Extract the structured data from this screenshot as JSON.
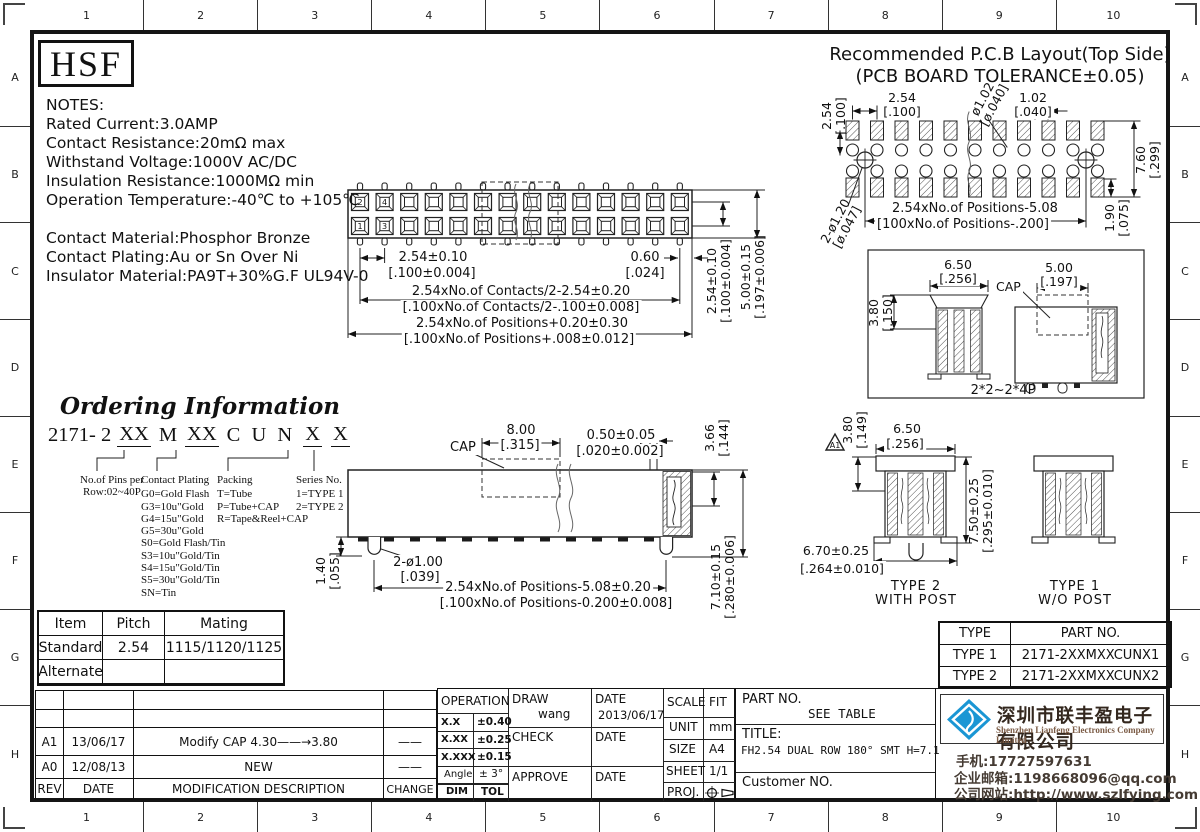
{
  "colors": {
    "accent_blue": "#1a96d4",
    "company_name": "#33271e",
    "company_sub": "#7b5b45",
    "line": "#1a1a1a"
  },
  "sheet": {
    "zones_cols": [
      "1",
      "2",
      "3",
      "4",
      "5",
      "6",
      "7",
      "8",
      "9",
      "10"
    ],
    "zones_rows": [
      "A",
      "B",
      "C",
      "D",
      "E",
      "F",
      "G",
      "H"
    ]
  },
  "logo_text": "HSF",
  "notes": {
    "lines": [
      "NOTES:",
      "Rated Current:3.0AMP",
      "Contact Resistance:20mΩ max",
      "Withstand Voltage:1000V AC/DC",
      "Insulation Resistance:1000MΩ min",
      "Operation Temperature:-40℃ to +105℃",
      "",
      "Contact Material:Phosphor Bronze",
      "Contact Plating:Au or Sn Over Ni",
      "Insulator Material:PA9T+30%G.F UL94V-0"
    ]
  },
  "pcb": {
    "title1": "Recommended P.C.B Layout(Top Side)",
    "title2": "(PCB BOARD TOLERANCE±0.05)",
    "dim_row_pitch_v": [
      "2.54",
      "[.100]"
    ],
    "dim_pitch": [
      "2.54",
      "[.100]"
    ],
    "dim_hole_sm": [
      "ø1.02",
      "[ø.040]"
    ],
    "dim_half": [
      "1.02",
      "[.040]"
    ],
    "dim_span_v": [
      "7.60",
      "[.299]"
    ],
    "dim_off_v": [
      "1.90",
      "[.075]"
    ],
    "dim_hole_lg": [
      "2-ø1.20",
      "[ø.047]"
    ],
    "dim_positions": [
      "2.54xNo.of Positions-5.08",
      "[100xNo.of Positions-.200]"
    ]
  },
  "top_view": {
    "pins": [
      "2",
      "4",
      "1",
      "3"
    ],
    "dim_pitch": [
      "2.54±0.10",
      "[.100±0.004]"
    ],
    "dim_end": [
      "0.60",
      "[.024]"
    ],
    "dim_contacts": [
      "2.54xNo.of Contacts/2-2.54±0.20",
      "[.100xNo.of Contacts/2-.100±0.008]"
    ],
    "dim_positions": [
      "2.54xNo.of Positions+0.20±0.30",
      "[.100xNo.of Positions+.008±0.012]"
    ],
    "dim_row_v": [
      "2.54±0.10",
      "[.100±0.004]"
    ],
    "dim_body_v": [
      "5.00±0.15",
      "[.197±0.006]"
    ]
  },
  "section_box": {
    "dim_left_w": [
      "6.50",
      "[.256]"
    ],
    "dim_cap_w": [
      "5.00",
      "[.197]"
    ],
    "cap_label": "CAP",
    "dim_cap_h_v": [
      "3.80",
      "[.150]"
    ],
    "range_label": "2*2~2*4P"
  },
  "ordering": {
    "title": "Ordering Information",
    "code": [
      "2171- 2",
      "XX",
      "M",
      "XX",
      "C U N",
      "X",
      "X"
    ],
    "pins_l1": "No.of Pins per",
    "pins_l2": "Row:02~40P",
    "plating_title": "Contact Plating",
    "plating": [
      "G0=Gold Flash",
      "G3=10u\"Gold",
      "G4=15u\"Gold",
      "G5=30u\"Gold",
      "S0=Gold Flash/Tin",
      "S3=10u\"Gold/Tin",
      "S4=15u\"Gold/Tin",
      "S5=30u\"Gold/Tin",
      "SN=Tin"
    ],
    "packing_title": "Packing",
    "packing": [
      "T=Tube",
      "P=Tube+CAP",
      "R=Tape&Reel+CAP"
    ],
    "series_title": "Series No.",
    "series": [
      "1=TYPE 1",
      "2=TYPE 2"
    ]
  },
  "side_view": {
    "cap_label": "CAP",
    "dim_cap": [
      "8.00",
      "[.315]"
    ],
    "dim_pad": [
      "0.50±0.05",
      "[.020±0.002]"
    ],
    "dim_ch_v": [
      "3.66",
      "[.144]"
    ],
    "dim_post": [
      "2-ø1.00",
      "[.039]"
    ],
    "dim_ph_v": [
      "1.40",
      "[.055]"
    ],
    "dim_positions": [
      "2.54xNo.of Positions-5.08±0.20",
      "[.100xNo.of Positions-0.200±0.008]"
    ],
    "dim_h_v": [
      "7.10±0.15",
      "[.280±0.006]"
    ]
  },
  "type_views": {
    "flag": "A1",
    "dim_cap_v": [
      "3.80",
      "[.149]"
    ],
    "dim_w": [
      "6.50",
      "[.256]"
    ],
    "dim_h_v": [
      "7.50±0.25",
      "[.295±0.010]"
    ],
    "dim_feet": [
      "6.70±0.25",
      "[.264±0.010]"
    ],
    "type2_l1": "TYPE 2",
    "type2_l2": "WITH POST",
    "type1_l1": "TYPE 1",
    "type1_l2": "W/O POST"
  },
  "mating_table": {
    "headers": [
      "Item",
      "Pitch",
      "Mating"
    ],
    "rows": [
      [
        "Standard",
        "2.54",
        "1115/1120/1125"
      ],
      [
        "Alternate",
        "",
        ""
      ]
    ]
  },
  "revision_table": {
    "headers": [
      "REV",
      "DATE",
      "MODIFICATION DESCRIPTION",
      "CHANGE"
    ],
    "rows": [
      {
        "rev": "A1",
        "date": "13/06/17",
        "desc": "Modify CAP 4.30——→3.80",
        "change": "——"
      },
      {
        "rev": "A0",
        "date": "12/08/13",
        "desc": "NEW",
        "change": "——"
      }
    ]
  },
  "title_block": {
    "operation_label": "OPERATION",
    "tol": [
      {
        "k": "X.X",
        "v": "±0.40"
      },
      {
        "k": "X.XX",
        "v": "±0.25"
      },
      {
        "k": "X.XXX",
        "v": "±0.15"
      },
      {
        "k": "Angle",
        "v": "± 3°"
      },
      {
        "k": "DIM",
        "v": "TOL"
      }
    ],
    "draw_label": "DRAW",
    "drawn_by": "wang",
    "date_label": "DATE",
    "draw_date": "2013/06/17",
    "check_label": "CHECK",
    "approve_label": "APPROVE",
    "scale_label": "SCALE",
    "scale_value": "FIT",
    "unit_label": "UNIT",
    "unit_value": "mm",
    "size_label": "SIZE",
    "size_value": "A4",
    "sheet_label": "SHEET",
    "sheet_value": "1/1",
    "proj_label": "PROJ."
  },
  "part_block": {
    "part_no_label": "PART NO.",
    "part_no": "SEE TABLE",
    "title_label": "TITLE:",
    "title": "FH2.54 DUAL ROW 180° SMT H=7.1",
    "customer_label": "Customer NO."
  },
  "company": {
    "name_cn": "深圳市联丰盈电子有限公司",
    "name_en": "Shenzhen Lianfeng Electronics Company Limited",
    "phone": "手机:17727597631",
    "email": "企业邮箱:1198668096@qq.com",
    "website": "公司网站:http://www.szlfying.com"
  },
  "type_table": {
    "headers": [
      "TYPE",
      "PART NO."
    ],
    "rows": [
      [
        "TYPE 1",
        "2171-2XXMXXCUNX1"
      ],
      [
        "TYPE 2",
        "2171-2XXMXXCUNX2"
      ]
    ]
  }
}
